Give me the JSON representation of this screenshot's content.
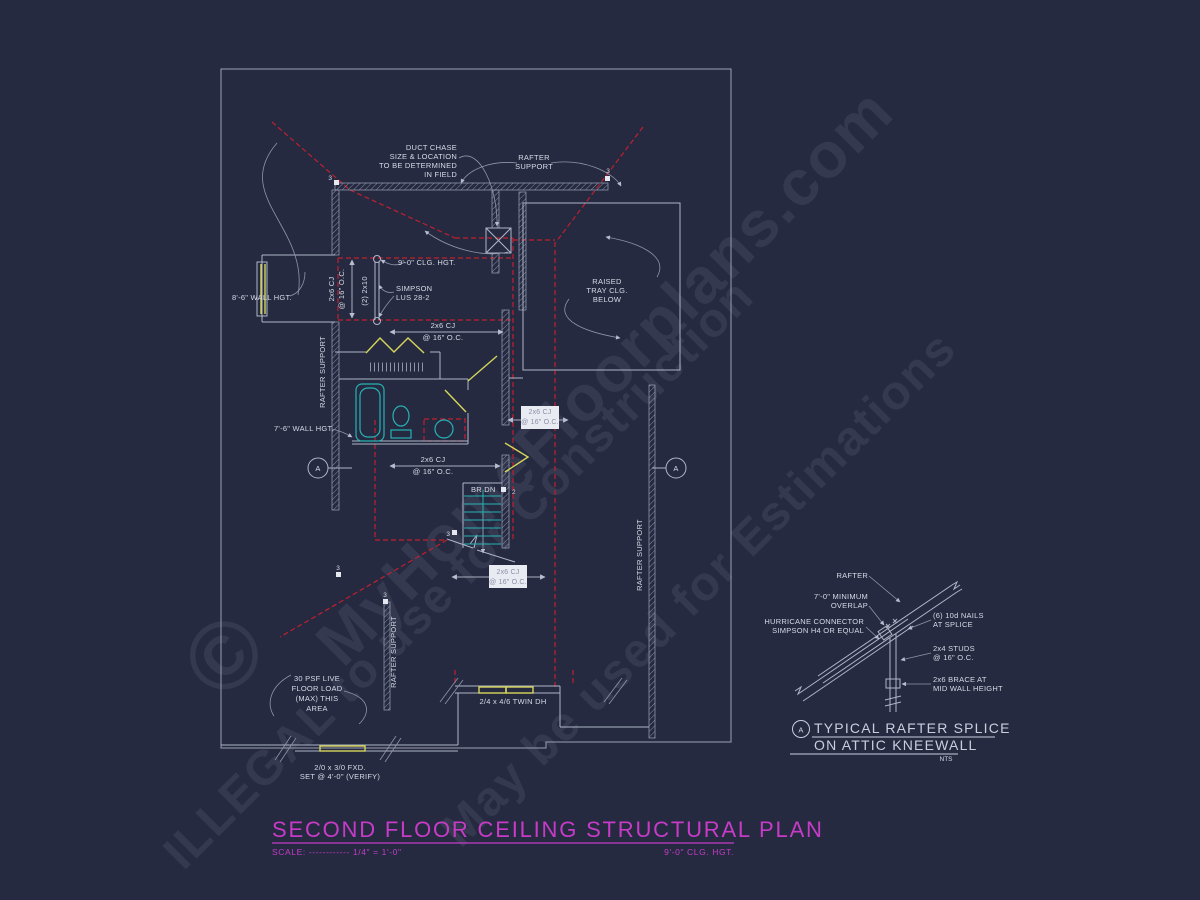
{
  "colors": {
    "background": "#252a41",
    "line": "#b0b6c8",
    "red": "#c0202e",
    "cyan": "#27b3b3",
    "yellow": "#d6d65a",
    "magenta": "#c73bc7",
    "watermark": "#cdd5f0"
  },
  "watermark": {
    "brand": "MyHomeFloorplans.com",
    "illegal": "ILLEGAL to use for Construction",
    "estimation": "May be used for Estimations",
    "copyright": "©"
  },
  "title": {
    "text": "SECOND FLOOR CEILING STRUCTURAL PLAN",
    "scale_label": "SCALE: ------------ 1/4\" = 1'-0\"",
    "clg_hgt": "9'-0\" CLG. HGT."
  },
  "labels": {
    "duct_chase": [
      "DUCT CHASE",
      "SIZE & LOCATION",
      "TO BE DETERMINED",
      "IN FIELD"
    ],
    "rafter_support_2l": [
      "RAFTER",
      "SUPPORT"
    ],
    "rafter_support": "RAFTER SUPPORT",
    "clg_hgt_9": "9'-0\" CLG. HGT.",
    "simpson": [
      "SIMPSON",
      "LUS 28-2"
    ],
    "strut_2x10": "(2) 2x10",
    "wall_hgt_86": "8'-6\" WALL HGT.",
    "wall_hgt_76": "7'-6\" WALL HGT.",
    "raised_tray": [
      "RAISED",
      "TRAY CLG.",
      "BELOW"
    ],
    "cj": [
      "2x6 CJ",
      "@ 16\" O.C."
    ],
    "br_dn": "BR DN",
    "num2": "2",
    "num3": "3",
    "live_load": [
      "30 PSF LIVE",
      "FLOOR LOAD",
      "(MAX) THIS",
      "AREA"
    ],
    "twin_dh": "2/4 x 4/6 TWIN DH",
    "fxd": [
      "2/0 x 3/0 FXD.",
      "SET @ 4'-0\" (VERIFY)"
    ],
    "section_a": "A"
  },
  "detail": {
    "labels": {
      "rafter": "RAFTER",
      "overlap": [
        "7'-0\" MINIMUM",
        "OVERLAP"
      ],
      "hurricane": [
        "HURRICANE CONNECTOR",
        "SIMPSON H4 OR EQUAL"
      ],
      "nails": [
        "(6) 10d NAILS",
        "AT SPLICE"
      ],
      "studs": [
        "2x4 STUDS",
        "@ 16\" O.C."
      ],
      "brace": [
        "2x6 BRACE AT",
        "MID WALL HEIGHT"
      ]
    },
    "marker": "A",
    "title": [
      "TYPICAL RAFTER SPLICE",
      "ON ATTIC KNEEWALL"
    ],
    "scale": "NTS"
  }
}
